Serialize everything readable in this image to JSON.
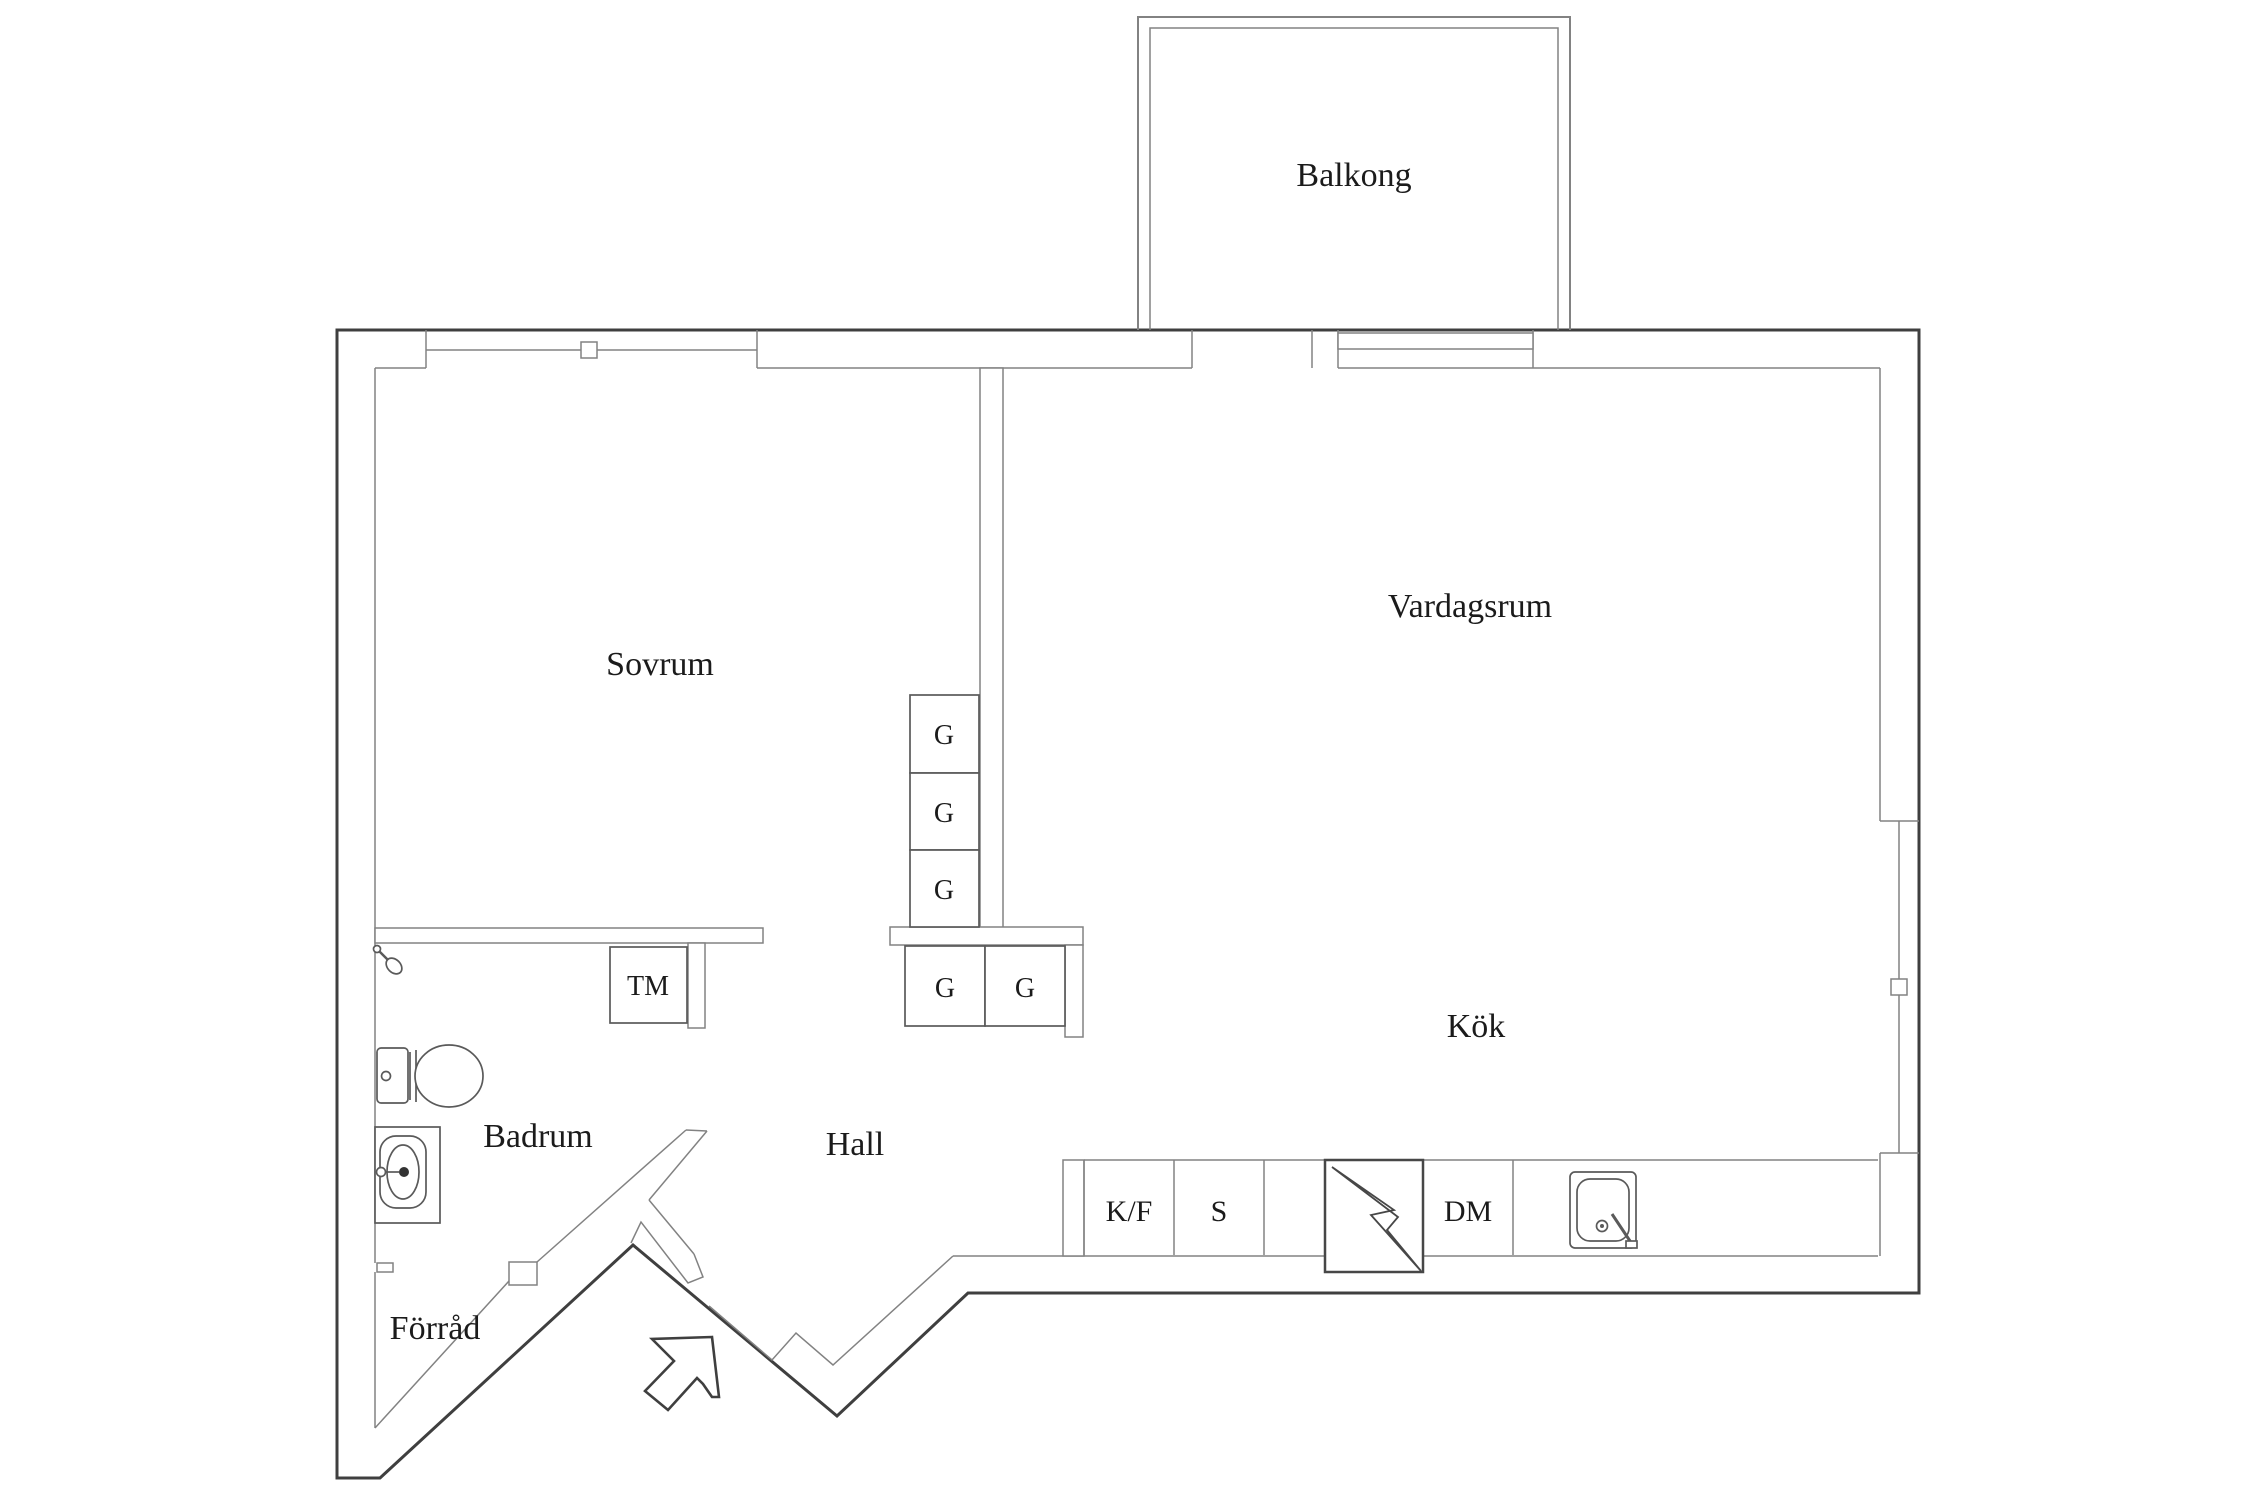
{
  "floorplan": {
    "rooms": {
      "balcony": "Balkong",
      "bedroom": "Sovrum",
      "living_room": "Vardagsrum",
      "kitchen": "Kök",
      "bathroom": "Badrum",
      "hall": "Hall",
      "storage": "Förråd"
    },
    "fixtures": {
      "wardrobes": [
        "G",
        "G",
        "G",
        "G",
        "G"
      ],
      "washing_machine": "TM"
    },
    "kitchen_units": {
      "fridge_freezer": "K/F",
      "stove": "S",
      "dishwasher": "DM"
    },
    "colors": {
      "background": "#ffffff",
      "outer_wall": "#3f3f3f",
      "inner_line": "#828282",
      "text": "#1b1b1b"
    }
  }
}
